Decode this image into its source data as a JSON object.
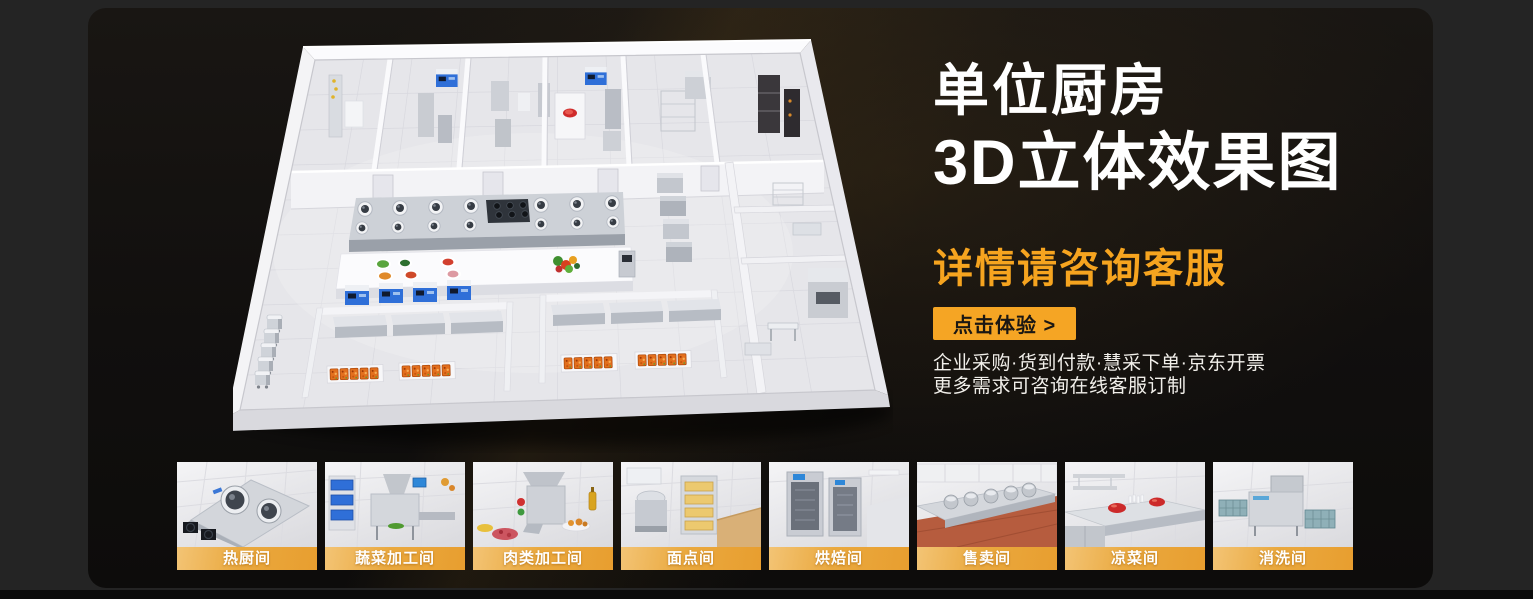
{
  "hero": {
    "headline_line1": "单位厨房",
    "headline_line2": "3D立体效果图",
    "subtitle": "详情请咨询客服",
    "cta_label": "点击体验 >",
    "desc_line1": "企业采购·货到付款·慧采下单·京东开票",
    "desc_line2": "更多需求可咨询在线客服订制"
  },
  "illustration": {
    "name": "3d-kitchen-floorplan"
  },
  "gallery": {
    "items": [
      {
        "label": "热厨间",
        "scene": "hot-kitchen"
      },
      {
        "label": "蔬菜加工间",
        "scene": "vegetable-processing"
      },
      {
        "label": "肉类加工间",
        "scene": "meat-processing"
      },
      {
        "label": "面点间",
        "scene": "pastry-room"
      },
      {
        "label": "烘焙间",
        "scene": "baking-room"
      },
      {
        "label": "售卖间",
        "scene": "serving-room"
      },
      {
        "label": "凉菜间",
        "scene": "cold-dish-room"
      },
      {
        "label": "消洗间",
        "scene": "dishwashing-room"
      }
    ]
  },
  "colors": {
    "accent_orange": "#F6A41F",
    "cta_bg": "#F5A524",
    "cta_text": "#1A1713",
    "headline": "#FFFFFF",
    "label_strip_from": "#F3C475",
    "label_strip_to": "#E89E2F",
    "panel_bg": "#141210",
    "outer_bg": "#242424"
  }
}
